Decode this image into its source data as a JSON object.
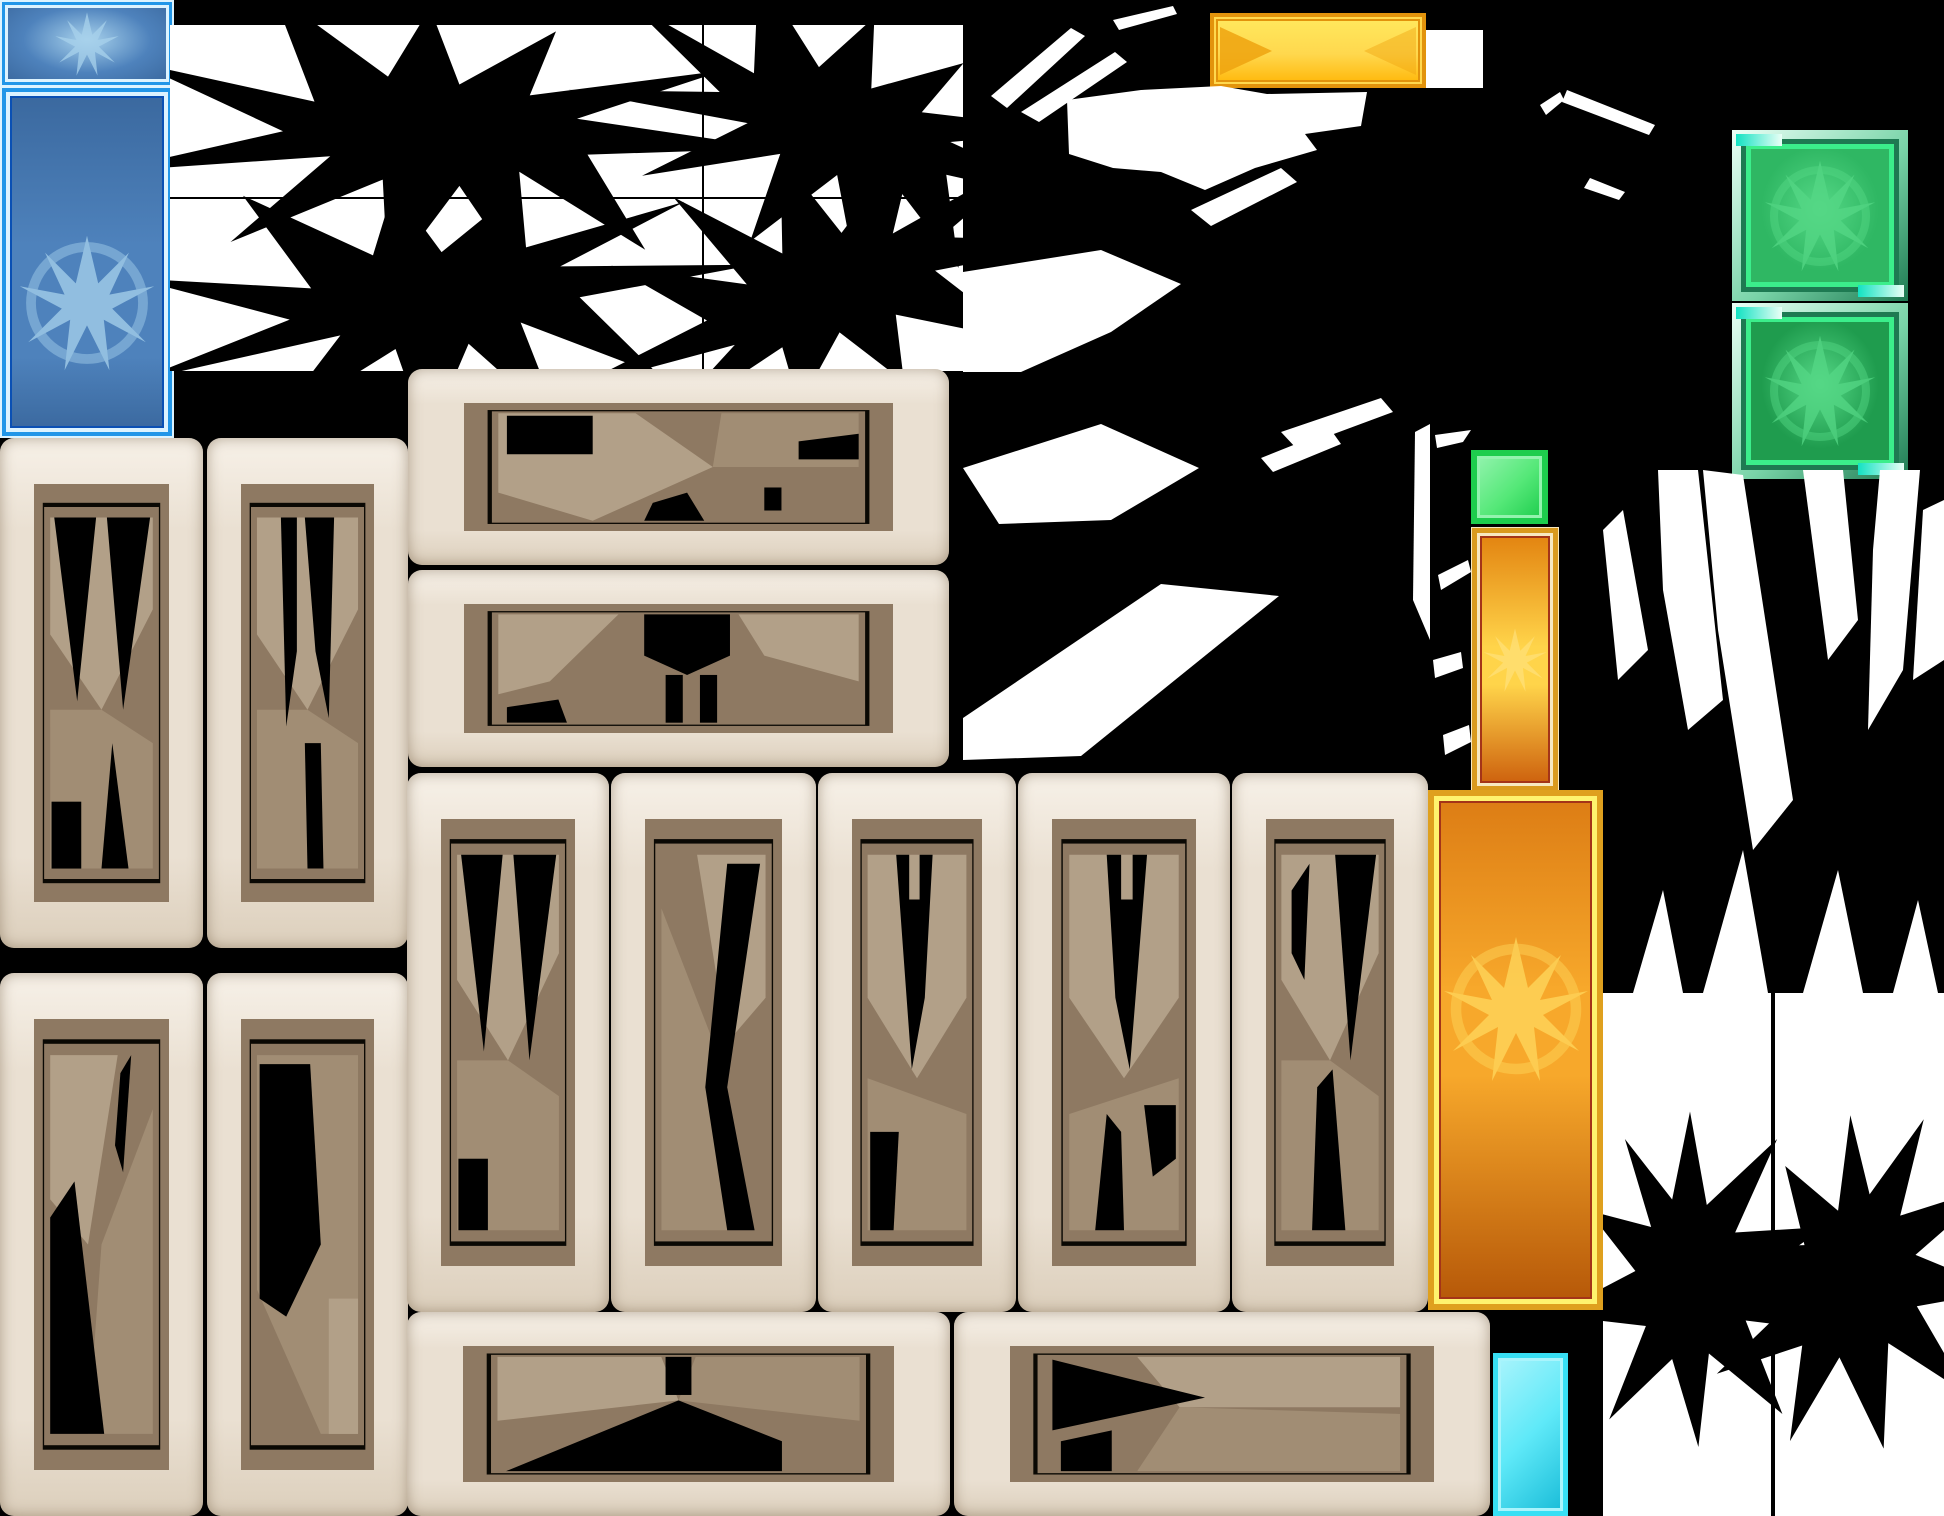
{
  "app": {
    "kind": "game-texture-atlas",
    "description": "Sprite sheet of game UI gem panels, stone frame plates and black/white starburst alpha masks"
  },
  "canvas": {
    "width": 1944,
    "height": 1516,
    "background": "#000000"
  },
  "palette": {
    "bg": "#000000",
    "white": "#FFFFFF",
    "blue_frame_light": "#DCF3FF",
    "blue_frame": "#2196E8",
    "blue_frame_dark": "#0A50B4",
    "blue_fill": "#4E82BC",
    "blue_fill_dark": "#3A689E",
    "blue_emblem": "#A8D2EC",
    "banner_border": "#E2930C",
    "banner_fill_top": "#FFE95E",
    "banner_fill_bottom": "#FFB708",
    "banner_chevron": "#EFA30F",
    "banner_inner": "#FFD84E",
    "green_bevel_light": "#EAFFF6",
    "green_bevel": "#79D4A8",
    "green_teal": "#12E2C2",
    "green_frame_dark": "#1E7A52",
    "green_border": "#3BEE8B",
    "green_fill_1": "#2FB763",
    "green_fill_2": "#1F9C4E",
    "green_emblem": "#55D886",
    "gsq_border": "#1ECD4D",
    "gsq_fill": "#55E878",
    "gsq_light": "#93F3AE",
    "or_frame": "#D99A1E",
    "or_frame_light": "#F7E8C0",
    "or_inner_border": "#A43418",
    "or_fill_top": "#E2820F",
    "or_fill_mid": "#FFD44A",
    "or_fill_bottom": "#CC5E0C",
    "or_emblem": "#FFE58A",
    "big_frame": "#DFA01E",
    "big_frame_bright": "#FFF36E",
    "big_fill_top": "#DC7C14",
    "big_fill_mid": "#F7A82B",
    "big_fill_bottom": "#B55708",
    "big_emblem": "#FFD95E",
    "cyan_border": "#38DFF4",
    "cyan_fill": "#5FE9F8",
    "cyan_light": "#A9F4FC",
    "cyan_dark": "#19BCD8",
    "cream_hi": "#F7F1E8",
    "cream_mid": "#EAE0D2",
    "cream_lo": "#DCCFBC",
    "taupe": "#8E7962",
    "tan1": "#B2A088",
    "tan2": "#A18D74",
    "line": "#0A0803"
  },
  "sprites": {
    "blue_gem_small": {
      "label": "blue gem button",
      "x": 2,
      "y": 2,
      "w": 170,
      "h": 83
    },
    "blue_panel_tall": {
      "label": "blue tall gem panel",
      "x": 2,
      "y": 88,
      "w": 170,
      "h": 348
    },
    "mask_sheet": {
      "label": "white burst-mask grid",
      "x": 170,
      "y": 25,
      "w": 793,
      "h": 346
    },
    "yellow_banner": {
      "label": "gold banner bar",
      "x": 1210,
      "y": 13,
      "w": 216,
      "h": 75
    },
    "white_square": {
      "label": "blank white tile",
      "x": 1426,
      "y": 30,
      "w": 57,
      "h": 58
    },
    "green_gem_1": {
      "label": "green gem tile bright",
      "x": 1732,
      "y": 130,
      "w": 176,
      "h": 171
    },
    "green_gem_2": {
      "label": "green gem tile dark",
      "x": 1732,
      "y": 303,
      "w": 176,
      "h": 176
    },
    "green_square": {
      "label": "small green tile",
      "x": 1471,
      "y": 450,
      "w": 77,
      "h": 74
    },
    "orange_bar": {
      "label": "gold tall gauge bar",
      "x": 1472,
      "y": 528,
      "w": 86,
      "h": 263
    },
    "orange_panel": {
      "label": "large gold gem panel",
      "x": 1428,
      "y": 790,
      "w": 175,
      "h": 520
    },
    "cyan_panel": {
      "label": "cyan tile",
      "x": 1493,
      "y": 1353,
      "w": 75,
      "h": 163
    },
    "stone_l1r1": {
      "label": "stone plate",
      "x": 0,
      "y": 438,
      "w": 203,
      "h": 510
    },
    "stone_l2r1": {
      "label": "stone plate",
      "x": 207,
      "y": 438,
      "w": 201,
      "h": 510
    },
    "stone_l1r2": {
      "label": "stone plate",
      "x": 0,
      "y": 973,
      "w": 203,
      "h": 543
    },
    "stone_l2r2": {
      "label": "stone plate",
      "x": 207,
      "y": 973,
      "w": 201,
      "h": 543
    },
    "stone_tb1": {
      "label": "stone bar",
      "x": 408,
      "y": 369,
      "w": 541,
      "h": 196
    },
    "stone_tb2": {
      "label": "stone bar",
      "x": 408,
      "y": 570,
      "w": 541,
      "h": 197
    },
    "stone_v1": {
      "label": "stone plate",
      "x": 407,
      "y": 773,
      "w": 202,
      "h": 539
    },
    "stone_v2": {
      "label": "stone plate",
      "x": 611,
      "y": 773,
      "w": 205,
      "h": 539
    },
    "stone_v3": {
      "label": "stone plate",
      "x": 818,
      "y": 773,
      "w": 198,
      "h": 539
    },
    "stone_v4": {
      "label": "stone plate",
      "x": 1018,
      "y": 773,
      "w": 212,
      "h": 539
    },
    "stone_v5": {
      "label": "stone plate",
      "x": 1232,
      "y": 773,
      "w": 196,
      "h": 539
    },
    "stone_bb1": {
      "label": "stone bar",
      "x": 407,
      "y": 1312,
      "w": 543,
      "h": 204
    },
    "stone_bb2": {
      "label": "stone bar",
      "x": 954,
      "y": 1312,
      "w": 536,
      "h": 204
    },
    "frag_field_b": {
      "label": "black field white fragments",
      "x": 963,
      "y": 0,
      "w": 467,
      "h": 790
    },
    "burst_field_c": {
      "label": "burst masks right field",
      "x": 1603,
      "y": 470,
      "w": 341,
      "h": 1046
    },
    "slash_field_tr": {
      "label": "white slashes top right",
      "x": 1484,
      "y": 80,
      "w": 250,
      "h": 140
    },
    "slash_field_gap": {
      "label": "white slashes gap",
      "x": 1433,
      "y": 430,
      "w": 40,
      "h": 370
    }
  },
  "mask_sheet_grid": {
    "v_seam_local": 532,
    "h_seam_local": 172,
    "cells": 4
  }
}
